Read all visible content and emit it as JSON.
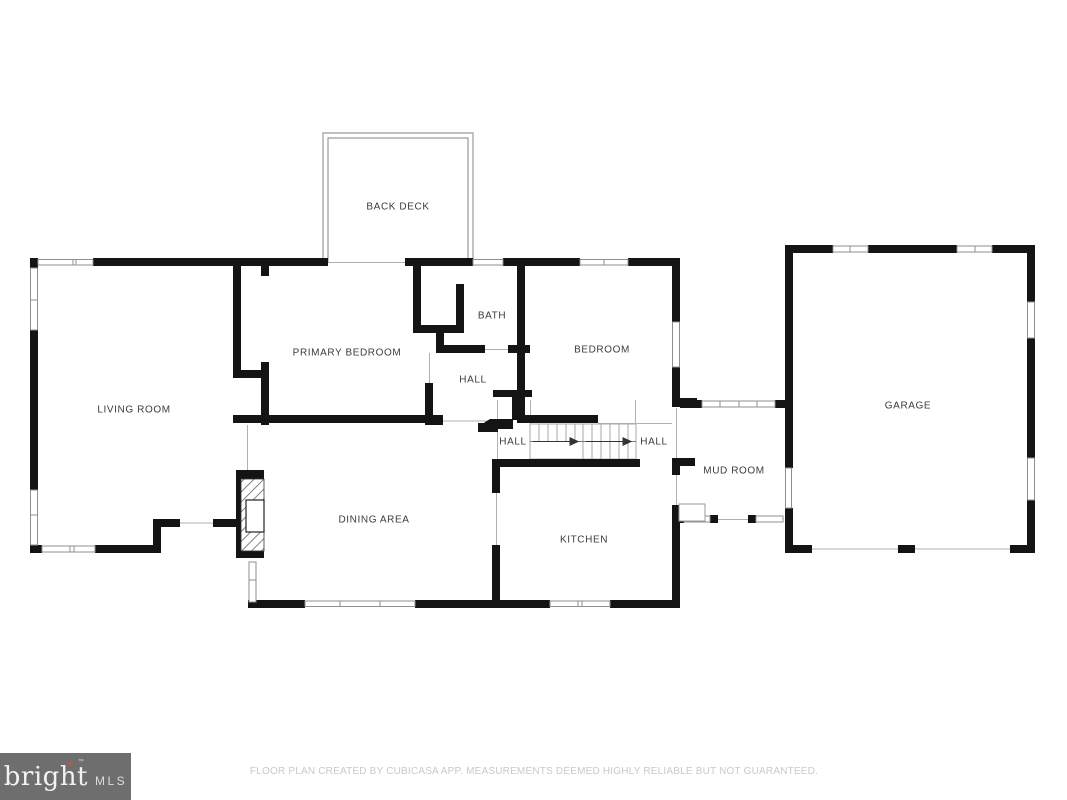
{
  "rooms": {
    "back_deck": {
      "label": "BACK DECK"
    },
    "living_room": {
      "label": "LIVING ROOM"
    },
    "primary_bedroom": {
      "label": "PRIMARY BEDROOM"
    },
    "bath": {
      "label": "BATH"
    },
    "hall_upper": {
      "label": "HALL"
    },
    "bedroom": {
      "label": "BEDROOM"
    },
    "hall_stairs": {
      "label": "HALL"
    },
    "hall_right": {
      "label": "HALL"
    },
    "dining_area": {
      "label": "DINING AREA"
    },
    "kitchen": {
      "label": "KITCHEN"
    },
    "mud_room": {
      "label": "MUD ROOM"
    },
    "garage": {
      "label": "GARAGE"
    }
  },
  "footer": {
    "disclaimer": "FLOOR PLAN CREATED BY CUBICASA APP. MEASUREMENTS DEEMED HIGHLY RELIABLE BUT NOT GUARANTEED."
  },
  "logo": {
    "brand": "bright",
    "suffix": "MLS",
    "star": "✦",
    "trademark": "™"
  },
  "colors": {
    "wall": "#141414",
    "thin_line": "#b0b0b0",
    "window_stroke": "#8f8f8f",
    "label_text": "#3b3b3b",
    "logo_background": "#6e6e6e",
    "logo_star": "#d0532f",
    "footer_text": "#c9c9c9"
  }
}
